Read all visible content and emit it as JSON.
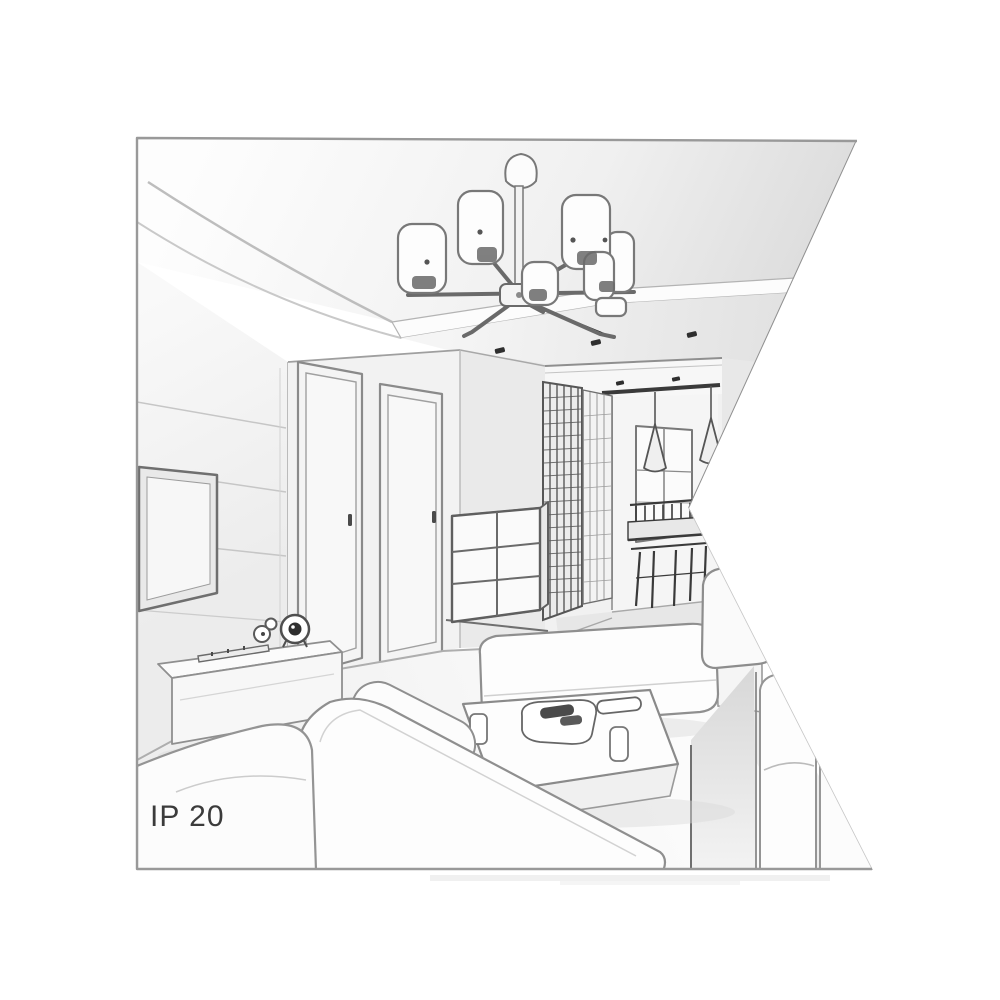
{
  "label": {
    "ip_rating": "IP 20"
  },
  "palette": {
    "background": "#ffffff",
    "frame_border": "#999999",
    "line_light": "#c4c4c4",
    "line_medium": "#8f8f8f",
    "line_dark": "#4a4a4a",
    "ink_black": "#2e2e2e",
    "fill_white": "#fdfdfd",
    "fill_light": "#f3f3f3",
    "fill_mid": "#e6e6e6",
    "fill_shadow": "#d9d9d9",
    "text_color": "#3b3b3b"
  },
  "scene": {
    "objects": [
      "ceiling-chandelier",
      "recessed-ceiling-panel",
      "ceiling-spotlights",
      "tv-wall-panels",
      "wall-mounted-tv",
      "media-console",
      "desk-clock",
      "mini-speakers",
      "remote-control",
      "left-door",
      "right-door",
      "drawer-chest",
      "hall-wardrobe-lattice",
      "hall-window",
      "cone-pendant-lamps",
      "dining-table-and-chairs",
      "bench-sofa",
      "corner-sofa",
      "right-sofa",
      "coffee-table",
      "tableware"
    ]
  }
}
